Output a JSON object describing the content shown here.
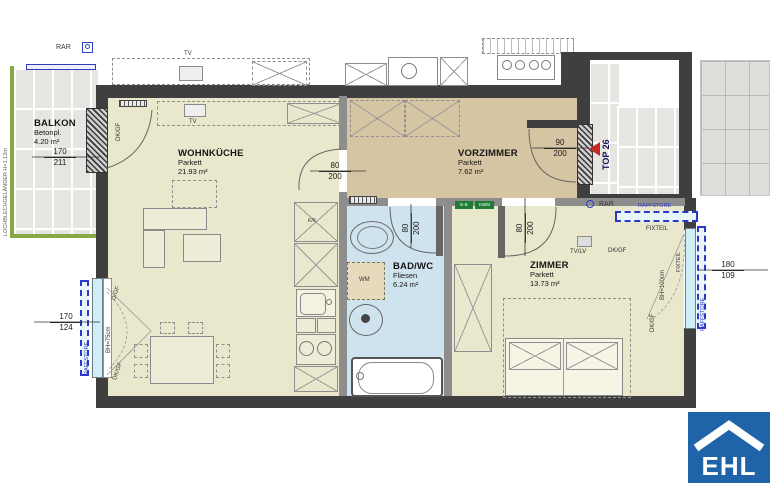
{
  "unit": {
    "top_label": "TOP 26"
  },
  "rooms": [
    {
      "name": "BALKON",
      "finish": "Betonpl.",
      "area": "4.20 m²"
    },
    {
      "name": "WOHNKÜCHE",
      "finish": "Parkett",
      "area": "21.93 m²"
    },
    {
      "name": "VORZIMMER",
      "finish": "Parkett",
      "area": "7.62 m²"
    },
    {
      "name": "BAD/WC",
      "finish": "Fliesen",
      "area": "6.24 m²"
    },
    {
      "name": "ZIMMER",
      "finish": "Parkett",
      "area": "13.73 m²"
    }
  ],
  "dims": {
    "balcony_door": {
      "w": "170",
      "h": "211"
    },
    "living_door": {
      "w": "80",
      "h": "200"
    },
    "entrance_door": {
      "w": "90",
      "h": "200"
    },
    "bath_door": {
      "w": "80",
      "h": "200"
    },
    "room_door": {
      "w": "80",
      "h": "200"
    },
    "left_window": {
      "w": "170",
      "h": "124"
    },
    "right_window": {
      "w": "180",
      "h": "109"
    }
  },
  "labels": {
    "rar": "RAR",
    "dk_gf": "DK/GF",
    "d_gf": "D/GF",
    "tv": "TV",
    "tv_lv": "TV/LV",
    "fixteil": "FIXTEIL",
    "raffstore": "RAFFSTORE",
    "wm": "WM",
    "kk": "K/K",
    "bh75": "BH=75cm",
    "bh100": "BH=100cm",
    "railing": "LOCHBLECHGELÄNDER H=1.12m",
    "tag1": "E-B",
    "tag2": "KWM"
  },
  "logo": {
    "text": "EHL"
  },
  "colors": {
    "wall": "#3f3f3f",
    "floor_parquet": "#eae8cc",
    "floor_hall": "#d6c5a2",
    "floor_bath": "#cfe3ef",
    "raffstore_blue": "#2a39c9",
    "balcony_green": "#86a943",
    "top_marker_red": "#c22a22",
    "logo_blue": "#1f63a8"
  }
}
